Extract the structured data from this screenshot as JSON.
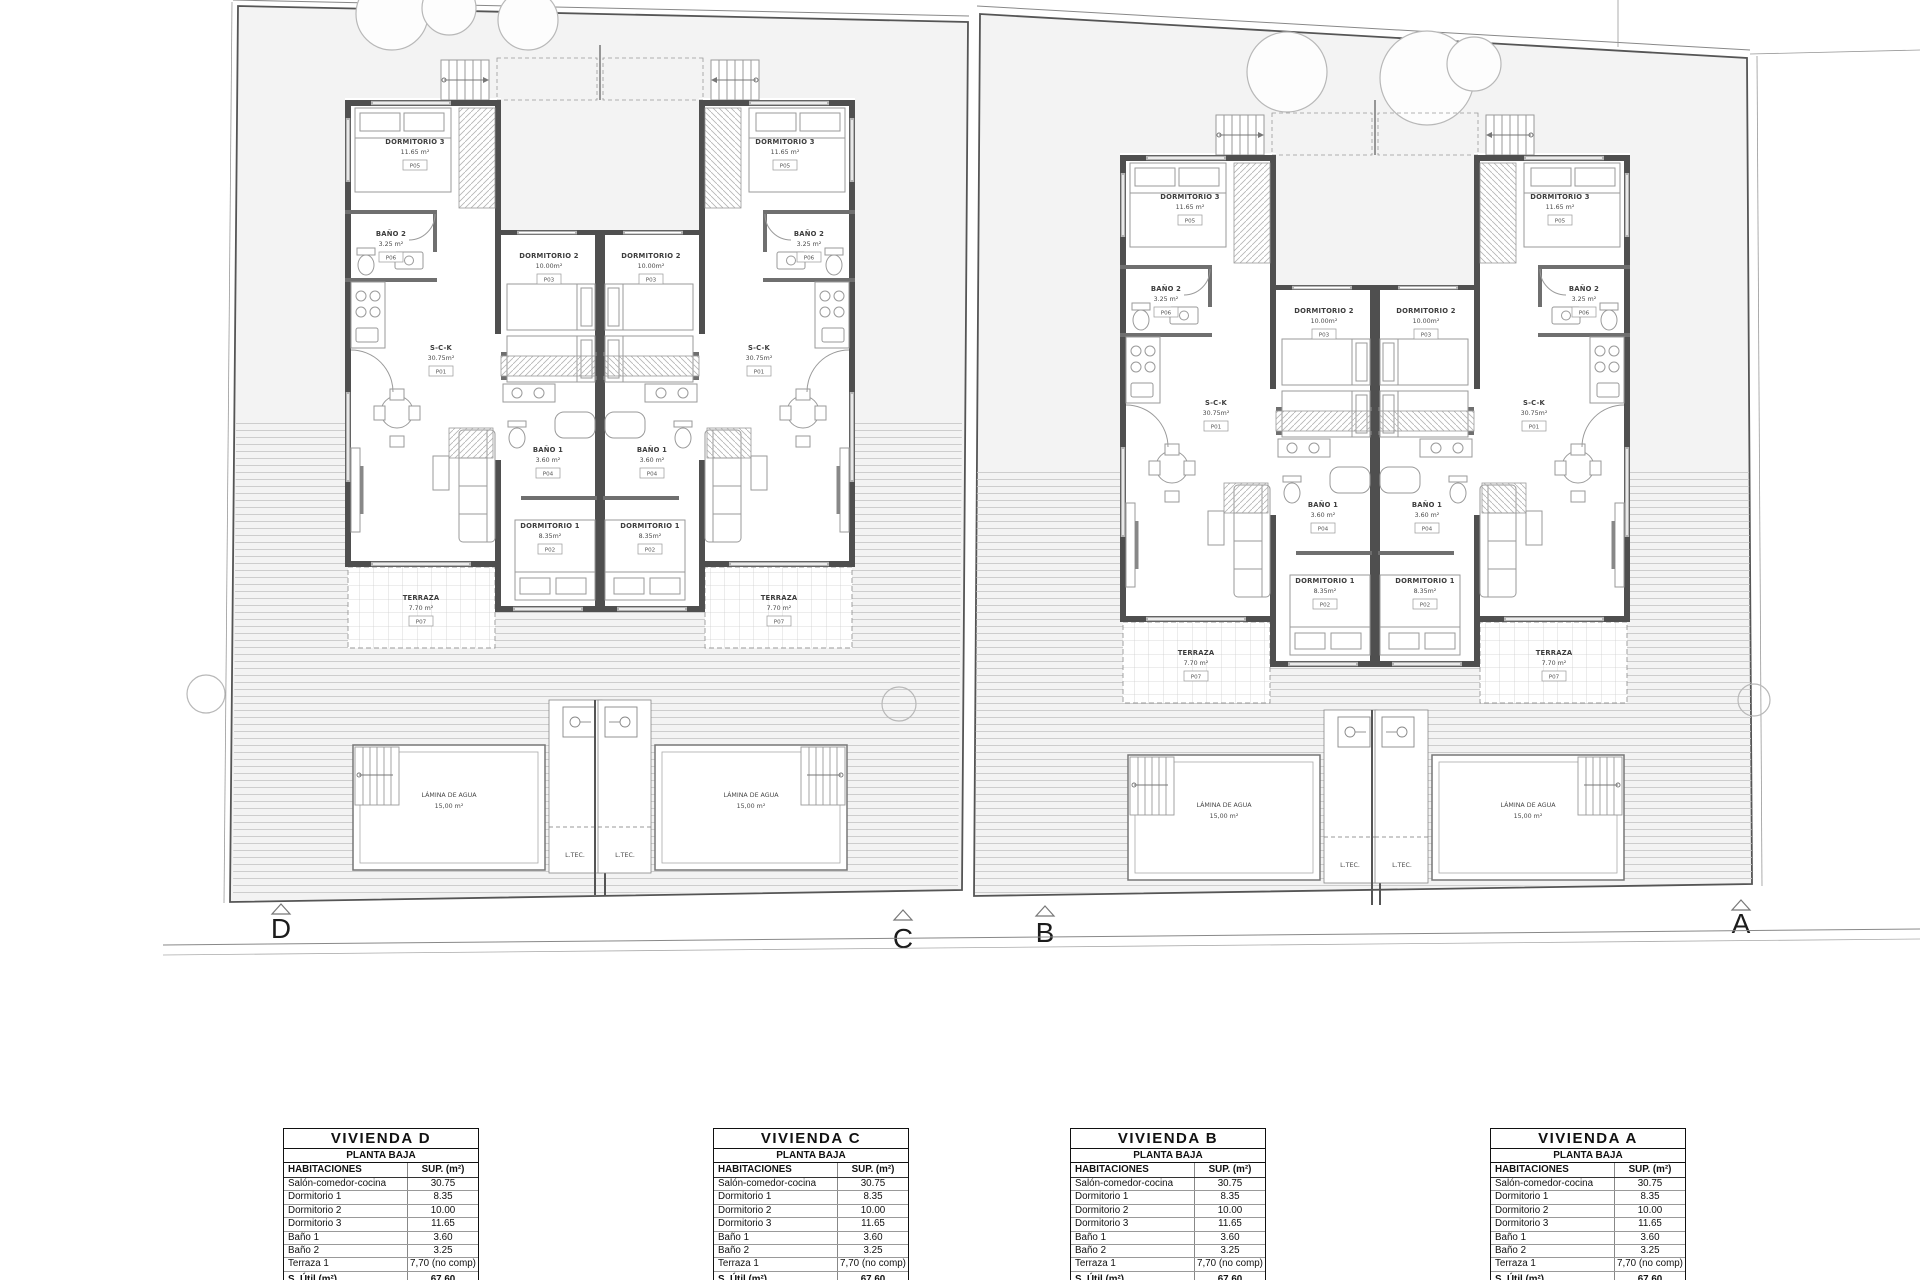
{
  "plan": {
    "rooms": {
      "dorm3": {
        "name": "DORMITORIO 3",
        "area": "11.65 m²",
        "code": "P05"
      },
      "dorm2": {
        "name": "DORMITORIO 2",
        "area": "10.00m²",
        "code": "P03"
      },
      "dorm1": {
        "name": "DORMITORIO 1",
        "area": "8.35m²",
        "code": "P02"
      },
      "bano1": {
        "name": "BAÑO 1",
        "area": "3.60 m²",
        "code": "P04"
      },
      "bano2": {
        "name": "BAÑO 2",
        "area": "3.25 m²",
        "code": "P06"
      },
      "sck": {
        "name": "S-C-K",
        "area": "30.75m²",
        "code": "P01"
      },
      "terraza": {
        "name": "TERRAZA",
        "area": "7.70 m²",
        "code": "P07"
      }
    },
    "pool": {
      "name": "LÁMINA DE AGUA",
      "area": "15,00 m²"
    },
    "ltec_label": "L.TEC."
  },
  "markers": [
    "D",
    "C",
    "B",
    "A"
  ],
  "tables": [
    {
      "title": "VIVIENDA D",
      "subtitle": "PLANTA BAJA",
      "col_rooms": "HABITACIONES",
      "col_sup": "SUP. (m²)",
      "rows": [
        [
          "Salón-comedor-cocina",
          "30.75"
        ],
        [
          "Dormitorio 1",
          "8.35"
        ],
        [
          "Dormitorio 2",
          "10.00"
        ],
        [
          "Dormitorio 3",
          "11.65"
        ],
        [
          "Baño 1",
          "3.60"
        ],
        [
          "Baño 2",
          "3.25"
        ],
        [
          "Terraza 1",
          "7,70 (no comp)"
        ]
      ],
      "total_label": "S. Útil (m²)",
      "total_value": "67.60"
    },
    {
      "title": "VIVIENDA C",
      "subtitle": "PLANTA BAJA",
      "col_rooms": "HABITACIONES",
      "col_sup": "SUP. (m²)",
      "rows": [
        [
          "Salón-comedor-cocina",
          "30.75"
        ],
        [
          "Dormitorio 1",
          "8.35"
        ],
        [
          "Dormitorio 2",
          "10.00"
        ],
        [
          "Dormitorio 3",
          "11.65"
        ],
        [
          "Baño 1",
          "3.60"
        ],
        [
          "Baño 2",
          "3.25"
        ],
        [
          "Terraza 1",
          "7,70 (no comp)"
        ]
      ],
      "total_label": "S. Útil (m²)",
      "total_value": "67.60"
    },
    {
      "title": "VIVIENDA B",
      "subtitle": "PLANTA BAJA",
      "col_rooms": "HABITACIONES",
      "col_sup": "SUP. (m²)",
      "rows": [
        [
          "Salón-comedor-cocina",
          "30.75"
        ],
        [
          "Dormitorio 1",
          "8.35"
        ],
        [
          "Dormitorio 2",
          "10.00"
        ],
        [
          "Dormitorio 3",
          "11.65"
        ],
        [
          "Baño 1",
          "3.60"
        ],
        [
          "Baño 2",
          "3.25"
        ],
        [
          "Terraza 1",
          "7,70 (no comp)"
        ]
      ],
      "total_label": "S. Útil (m²)",
      "total_value": "67.60"
    },
    {
      "title": "VIVIENDA A",
      "subtitle": "PLANTA BAJA",
      "col_rooms": "HABITACIONES",
      "col_sup": "SUP. (m²)",
      "rows": [
        [
          "Salón-comedor-cocina",
          "30.75"
        ],
        [
          "Dormitorio 1",
          "8.35"
        ],
        [
          "Dormitorio 2",
          "10.00"
        ],
        [
          "Dormitorio 3",
          "11.65"
        ],
        [
          "Baño 1",
          "3.60"
        ],
        [
          "Baño 2",
          "3.25"
        ],
        [
          "Terraza 1",
          "7,70 (no comp)"
        ]
      ],
      "total_label": "S. Útil (m²)",
      "total_value": "67.60"
    }
  ]
}
